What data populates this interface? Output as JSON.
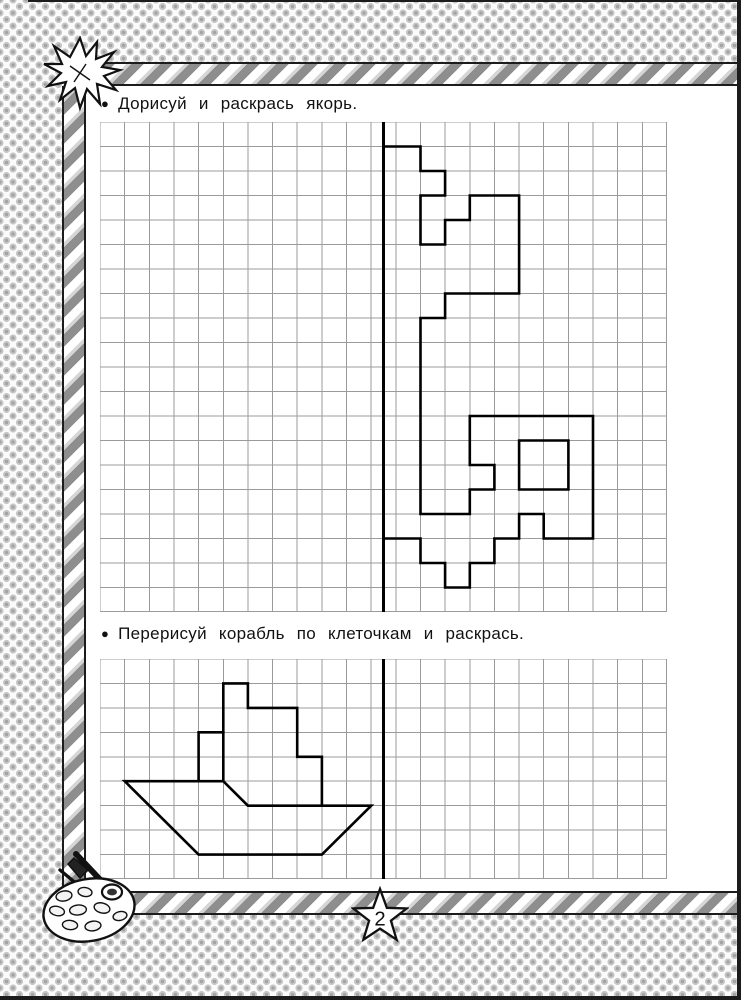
{
  "page_number": "2",
  "exercises": [
    {
      "bullet": "●",
      "instruction": "Дорисуй и раскрась якорь.",
      "grid": {
        "cols": 23,
        "rows": 20,
        "axis_col": 11.5
      },
      "figure": [
        {
          "name": "anchor-half-outline",
          "closed": false,
          "points": [
            [
              11.5,
              1
            ],
            [
              13,
              1
            ],
            [
              13,
              2
            ],
            [
              14,
              2
            ],
            [
              14,
              3
            ],
            [
              13,
              3
            ],
            [
              13,
              5
            ],
            [
              14,
              5
            ],
            [
              14,
              4
            ],
            [
              15,
              4
            ],
            [
              15,
              3
            ],
            [
              17,
              3
            ],
            [
              17,
              7
            ],
            [
              14,
              7
            ],
            [
              14,
              8
            ],
            [
              13,
              8
            ],
            [
              13,
              16
            ],
            [
              15,
              16
            ],
            [
              15,
              15
            ],
            [
              16,
              15
            ],
            [
              16,
              14
            ],
            [
              15,
              14
            ],
            [
              15,
              12
            ],
            [
              20,
              12
            ],
            [
              20,
              17
            ],
            [
              18,
              17
            ],
            [
              18,
              16
            ],
            [
              17,
              16
            ],
            [
              17,
              17
            ],
            [
              16,
              17
            ],
            [
              16,
              18
            ],
            [
              15,
              18
            ],
            [
              15,
              19
            ],
            [
              14,
              19
            ],
            [
              14,
              18
            ],
            [
              13,
              18
            ],
            [
              13,
              17
            ],
            [
              11.5,
              17
            ]
          ]
        },
        {
          "name": "anchor-ring-hole",
          "closed": true,
          "points": [
            [
              17,
              13
            ],
            [
              19,
              13
            ],
            [
              19,
              15
            ],
            [
              17,
              15
            ]
          ]
        }
      ]
    },
    {
      "bullet": "●",
      "instruction": "Перерисуй корабль по клеточкам и раскрась.",
      "grid": {
        "cols": 23,
        "rows": 9,
        "axis_col": 11.5
      },
      "figure": [
        {
          "name": "ship-hull",
          "closed": true,
          "points": [
            [
              1,
              5
            ],
            [
              5,
              5
            ],
            [
              6,
              6
            ],
            [
              11,
              6
            ],
            [
              9,
              8
            ],
            [
              4,
              8
            ]
          ]
        },
        {
          "name": "ship-superstructure",
          "closed": false,
          "points": [
            [
              4,
              5
            ],
            [
              4,
              3
            ],
            [
              5,
              3
            ],
            [
              5,
              1
            ],
            [
              6,
              1
            ],
            [
              6,
              2
            ],
            [
              8,
              2
            ],
            [
              8,
              4
            ],
            [
              9,
              4
            ],
            [
              9,
              6
            ]
          ]
        },
        {
          "name": "ship-cabin-divider",
          "closed": false,
          "points": [
            [
              5,
              3
            ],
            [
              5,
              5
            ]
          ]
        }
      ]
    }
  ],
  "colors": {
    "grid_line": "#9b9b9b",
    "figure_line": "#000000",
    "axis_line": "#000000",
    "ribbon_dark": "#8e8e8e",
    "ribbon_light": "#d6d6d6",
    "dot_pattern": "#a3a3a3"
  }
}
